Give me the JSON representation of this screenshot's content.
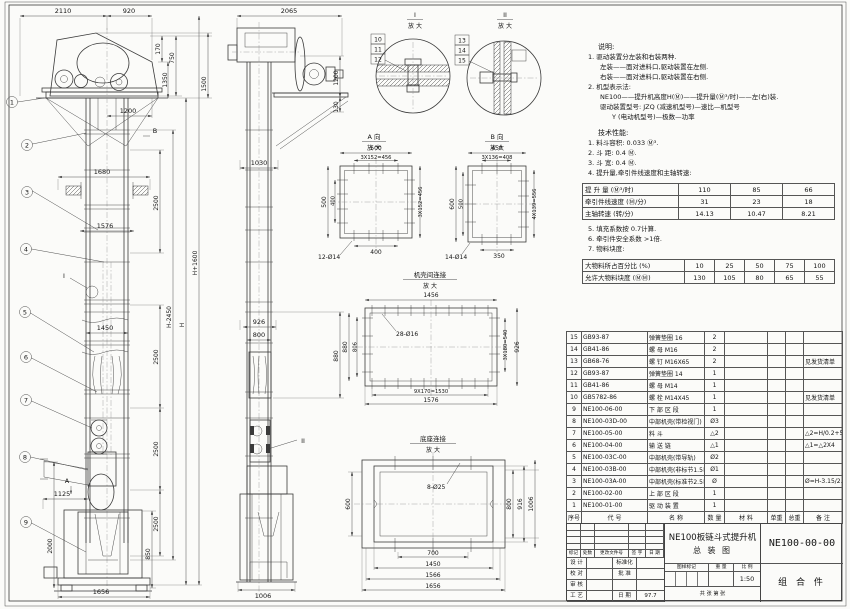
{
  "front_view": {
    "balloons": [
      "1",
      "2",
      "3",
      "4",
      "5",
      "6",
      "7",
      "8",
      "9"
    ],
    "section_labels": {
      "a": "A",
      "b": "B",
      "detail_i": "I"
    },
    "dims": {
      "d2110": "2110",
      "d920": "920",
      "d170": "170",
      "d750": "750",
      "d1350": "1350",
      "d1500": "1500",
      "d1200": "1200",
      "d1680": "1680",
      "d1576": "1576",
      "d1450": "1450",
      "d2500": "2500",
      "dHminus": "H-2450",
      "dH": "H",
      "dHplus": "H+1600",
      "d1125": "1125",
      "d2000": "2000",
      "d850": "850",
      "d1656": "1656"
    }
  },
  "side_view": {
    "section_label": "II",
    "dims": {
      "d2065": "2065",
      "d1200": "1200",
      "d130": "130",
      "d1030": "1030",
      "d926": "926",
      "d800": "800",
      "d880": "880",
      "d1006": "1006"
    }
  },
  "detail_i": {
    "label": "I",
    "zoom": "放 大",
    "balloons": [
      "10",
      "11",
      "12"
    ]
  },
  "detail_ii": {
    "label": "II",
    "zoom": "放 大",
    "balloons": [
      "13",
      "14",
      "15"
    ]
  },
  "view_a": {
    "label": "A 向",
    "zoom": "放 大",
    "dims": {
      "top": "500",
      "top2": "3X152=456",
      "left": "500",
      "left2": "400",
      "right": "3X152=456",
      "bottom": "400",
      "holes": "12-Ø14"
    }
  },
  "view_b": {
    "label": "B 向",
    "zoom": "放 大",
    "dims": {
      "top": "450",
      "top2": "3X136=408",
      "left": "600",
      "left2": "500",
      "right": "4X139=556",
      "bottom": "350",
      "holes": "14-Ø14"
    }
  },
  "casing_joint": {
    "title": "机壳间连接",
    "zoom": "放 大",
    "dims": {
      "top": "1456",
      "holes": "28-Ø16",
      "left_outer": "880",
      "left_inner": "806",
      "right_inner": "3X180=540",
      "right_outer": "926",
      "bottom_inner": "9X170=1530",
      "bottom_outer": "1576"
    }
  },
  "base_joint": {
    "title": "底座连接",
    "zoom": "放 大",
    "dims": {
      "holes": "8-Ø25",
      "left": "600",
      "right1": "800",
      "right2": "916",
      "right3": "1006",
      "bottom1": "700",
      "bottom2": "1450",
      "bottom3": "1566",
      "bottom4": "1656"
    }
  },
  "notes": {
    "title": "说明:",
    "lines": [
      {
        "text": "1. 驱动装置分左装和右装两种.",
        "indent": 0
      },
      {
        "text": "左装——面对进料口,驱动装置在左侧.",
        "indent": 1
      },
      {
        "text": "右装——面对进料口,驱动装置在右侧.",
        "indent": 1
      },
      {
        "text": "2. 机型表示法:",
        "indent": 0
      },
      {
        "text": "NE100——提升机高度H(Ⓜ)——提升量(Ⓜ³/时)——左(右)装.",
        "indent": 1
      },
      {
        "text": "驱动装置型号: JZQ (减速机型号)—速比—机型号",
        "indent": 1
      },
      {
        "text": "Y (电动机型号)—极数—功率",
        "indent": 2
      }
    ]
  },
  "tech": {
    "title": "技术性能:",
    "lines": [
      "1. 料斗容积: 0.033 Ⓜ³.",
      "2. 斗  距: 0.4 Ⓜ.",
      "3. 斗  宽: 0.4 Ⓜ.",
      "4. 提升量,牵引件线速度和主轴转速:"
    ],
    "speed_table": {
      "rows": [
        {
          "label": "提 升 量 (Ⓜ³/时)",
          "values": [
            "110",
            "85",
            "66"
          ]
        },
        {
          "label": "牵引件线速度 (Ⓜ/分)",
          "values": [
            "31",
            "23",
            "18"
          ]
        },
        {
          "label": "主轴转速 (转/分)",
          "values": [
            "14.13",
            "10.47",
            "8.21"
          ]
        }
      ]
    },
    "lines2": [
      "5. 填充系数按 0.7计算.",
      "6. 牵引件安全系数 >1倍.",
      "7. 物料块度:"
    ],
    "lump_table": {
      "rows": [
        {
          "label": "大物料所占百分比 (%)",
          "values": [
            "10",
            "25",
            "50",
            "75",
            "100"
          ]
        },
        {
          "label": "允许大物料块度 (ⓂⓂ)",
          "values": [
            "130",
            "105",
            "80",
            "65",
            "55"
          ]
        }
      ]
    }
  },
  "bom": {
    "header": {
      "no": "序号",
      "code": "代  号",
      "name": "名  称",
      "qty": "数 量",
      "material": "材  料",
      "unit_weight": "单重",
      "total_weight": "总重",
      "remark": "备  注"
    },
    "rows": [
      {
        "no": "15",
        "code": "GB93-87",
        "name": "弹簧垫圈  16",
        "qty": "2",
        "remark": ""
      },
      {
        "no": "14",
        "code": "GB41-86",
        "name": "螺  母  M16",
        "qty": "2",
        "remark": ""
      },
      {
        "no": "13",
        "code": "GB68-76",
        "name": "螺  钉  M16X65",
        "qty": "2",
        "remark": "见发货清单"
      },
      {
        "no": "12",
        "code": "GB93-87",
        "name": "弹簧垫圈  14",
        "qty": "1",
        "remark": ""
      },
      {
        "no": "11",
        "code": "GB41-86",
        "name": "螺  母  M14",
        "qty": "1",
        "remark": ""
      },
      {
        "no": "10",
        "code": "GB5782-86",
        "name": "螺  栓  M14X45",
        "qty": "1",
        "remark": "见发货清单"
      },
      {
        "no": "9",
        "code": "NE100-06-00",
        "name": "下 部 区 段",
        "qty": "1",
        "remark": ""
      },
      {
        "no": "8",
        "code": "NE100-03D-00",
        "name": "中部机壳(带检视门)",
        "qty": "Ø3",
        "remark": ""
      },
      {
        "no": "7",
        "code": "NE100-05-00",
        "name": "料  斗",
        "qty": "△2",
        "remark": "△2=H/0.2+5.75"
      },
      {
        "no": "6",
        "code": "NE100-04-00",
        "name": "输 送 链",
        "qty": "△1",
        "remark": "△1=△2X4"
      },
      {
        "no": "5",
        "code": "NE100-03C-00",
        "name": "中部机壳(带导轨)",
        "qty": "Ø2",
        "remark": ""
      },
      {
        "no": "4",
        "code": "NE100-03B-00",
        "name": "中部机壳(非标节1.5Ⓜ,1Ⓜ)",
        "qty": "Ø1",
        "remark": ""
      },
      {
        "no": "3",
        "code": "NE100-03A-00",
        "name": "中部机壳(标准节2.5Ⓜ)",
        "qty": "Ø",
        "remark": "Ø=H-3.15/2.5"
      },
      {
        "no": "2",
        "code": "NE100-02-00",
        "name": "上 部 区 段",
        "qty": "1",
        "remark": ""
      },
      {
        "no": "1",
        "code": "NE100-01-00",
        "name": "驱 动 装 置",
        "qty": "1",
        "remark": ""
      }
    ]
  },
  "title_block": {
    "product_title": "NE100板链斗式提升机",
    "sheet_title": "总  装  图",
    "drawing_no": "NE100-00-00",
    "part_type": "组 合 件",
    "rev_header": [
      "标记",
      "处数",
      "更改文件号",
      "签 字",
      "日 期"
    ],
    "sign_labels": [
      "设 计",
      "校 对",
      "审 核",
      "工 艺"
    ],
    "sign_labels2": [
      "标准化",
      "批 准",
      "",
      "日 期"
    ],
    "date_value": "97.7",
    "stamp_labels": [
      "图样标记",
      "重 量",
      "比 例"
    ],
    "scale_value": "1:50",
    "sheet_note": "共  张  第  张"
  }
}
